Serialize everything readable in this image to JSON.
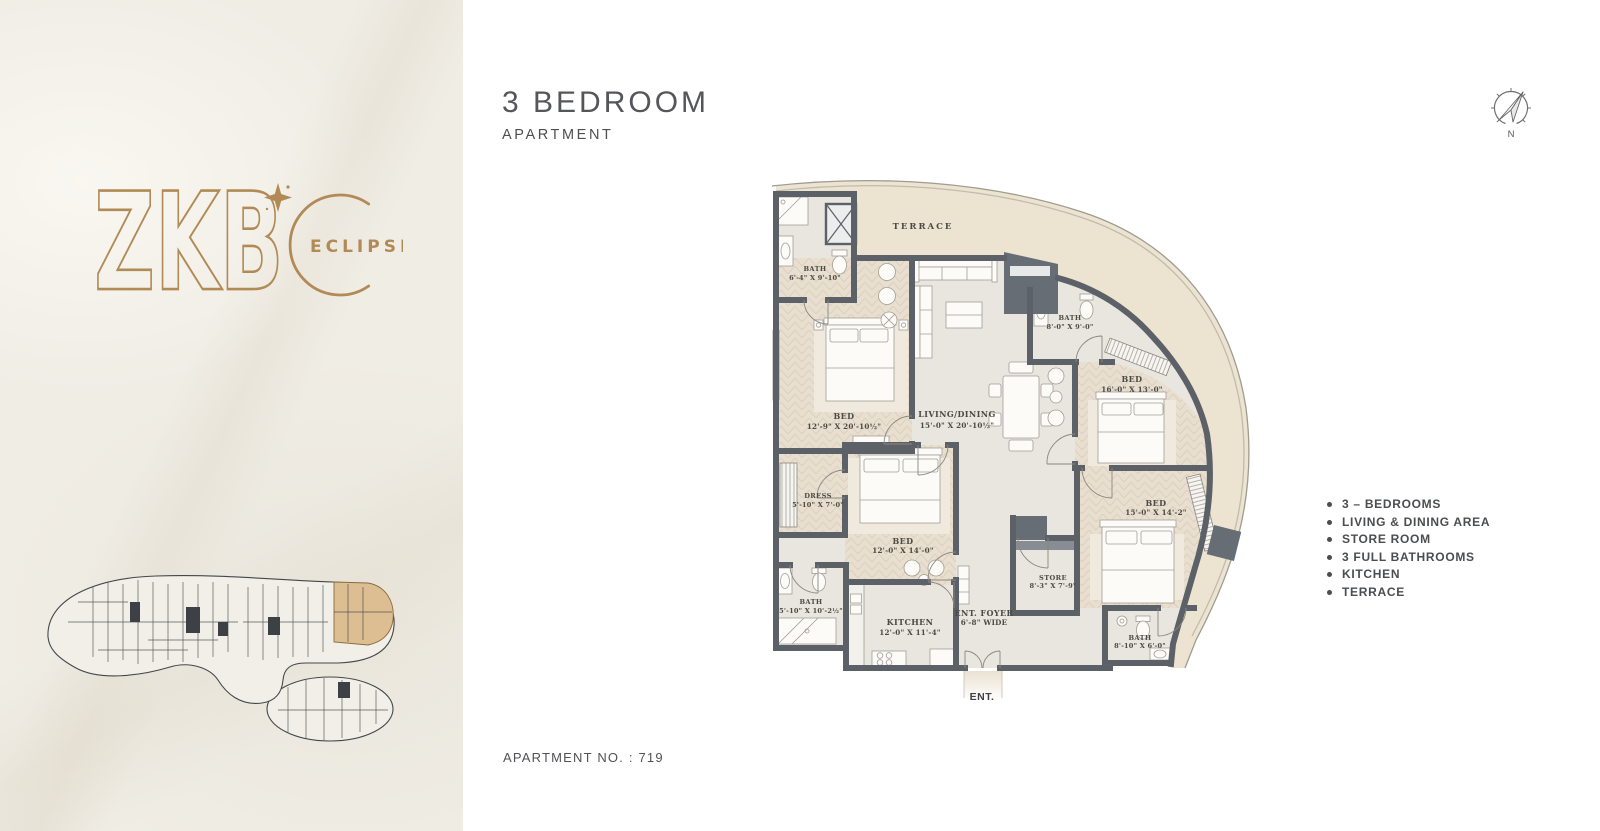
{
  "brand": {
    "name": "ZKB",
    "sub": "ECLIPSE",
    "accent": "#b18a56"
  },
  "header": {
    "title": "3 BEDROOM",
    "subtitle": "APARTMENT"
  },
  "compass": {
    "north_label": "N"
  },
  "features": [
    "3 – BEDROOMS",
    "LIVING & DINING AREA",
    "STORE ROOM",
    "3 FULL BATHROOMS",
    "KITCHEN",
    "TERRACE"
  ],
  "footer": {
    "apartment_no": "APARTMENT NO. : 719"
  },
  "floorplan": {
    "terrace": {
      "name": "TERRACE"
    },
    "bath_top": {
      "name": "BATH",
      "dims": "6'-4\" X 9'-10\""
    },
    "bed_master": {
      "name": "BED",
      "dims": "12'-9\" X 20'-10½\""
    },
    "living": {
      "name": "LIVING/DINING",
      "dims": "15'-0\" X 20'-10½\""
    },
    "bath_right": {
      "name": "BATH",
      "dims": "8'-0\" X 9'-0\""
    },
    "bed_right_top": {
      "name": "BED",
      "dims": "16'-0\" X 13'-0\""
    },
    "dress": {
      "name": "DRESS",
      "dims": "5'-10\" X 7'-0\""
    },
    "bed_middle": {
      "name": "BED",
      "dims": "12'-0\" X 14'-0\""
    },
    "bed_right_bottom": {
      "name": "BED",
      "dims": "15'-0\" X 14'-2\""
    },
    "bath_left": {
      "name": "BATH",
      "dims": "5'-10\" X 10'-2½\""
    },
    "kitchen": {
      "name": "KITCHEN",
      "dims": "12'-0\" X 11'-4\""
    },
    "foyer": {
      "name": "ENT. FOYER",
      "dims": "6'-8\" WIDE"
    },
    "store": {
      "name": "STORE",
      "dims": "8'-3\" X 7'-9\""
    },
    "bath_ensuite": {
      "name": "BATH",
      "dims": "8'-10\" X 6'-0\""
    },
    "entrance": {
      "name": "ENT."
    }
  }
}
